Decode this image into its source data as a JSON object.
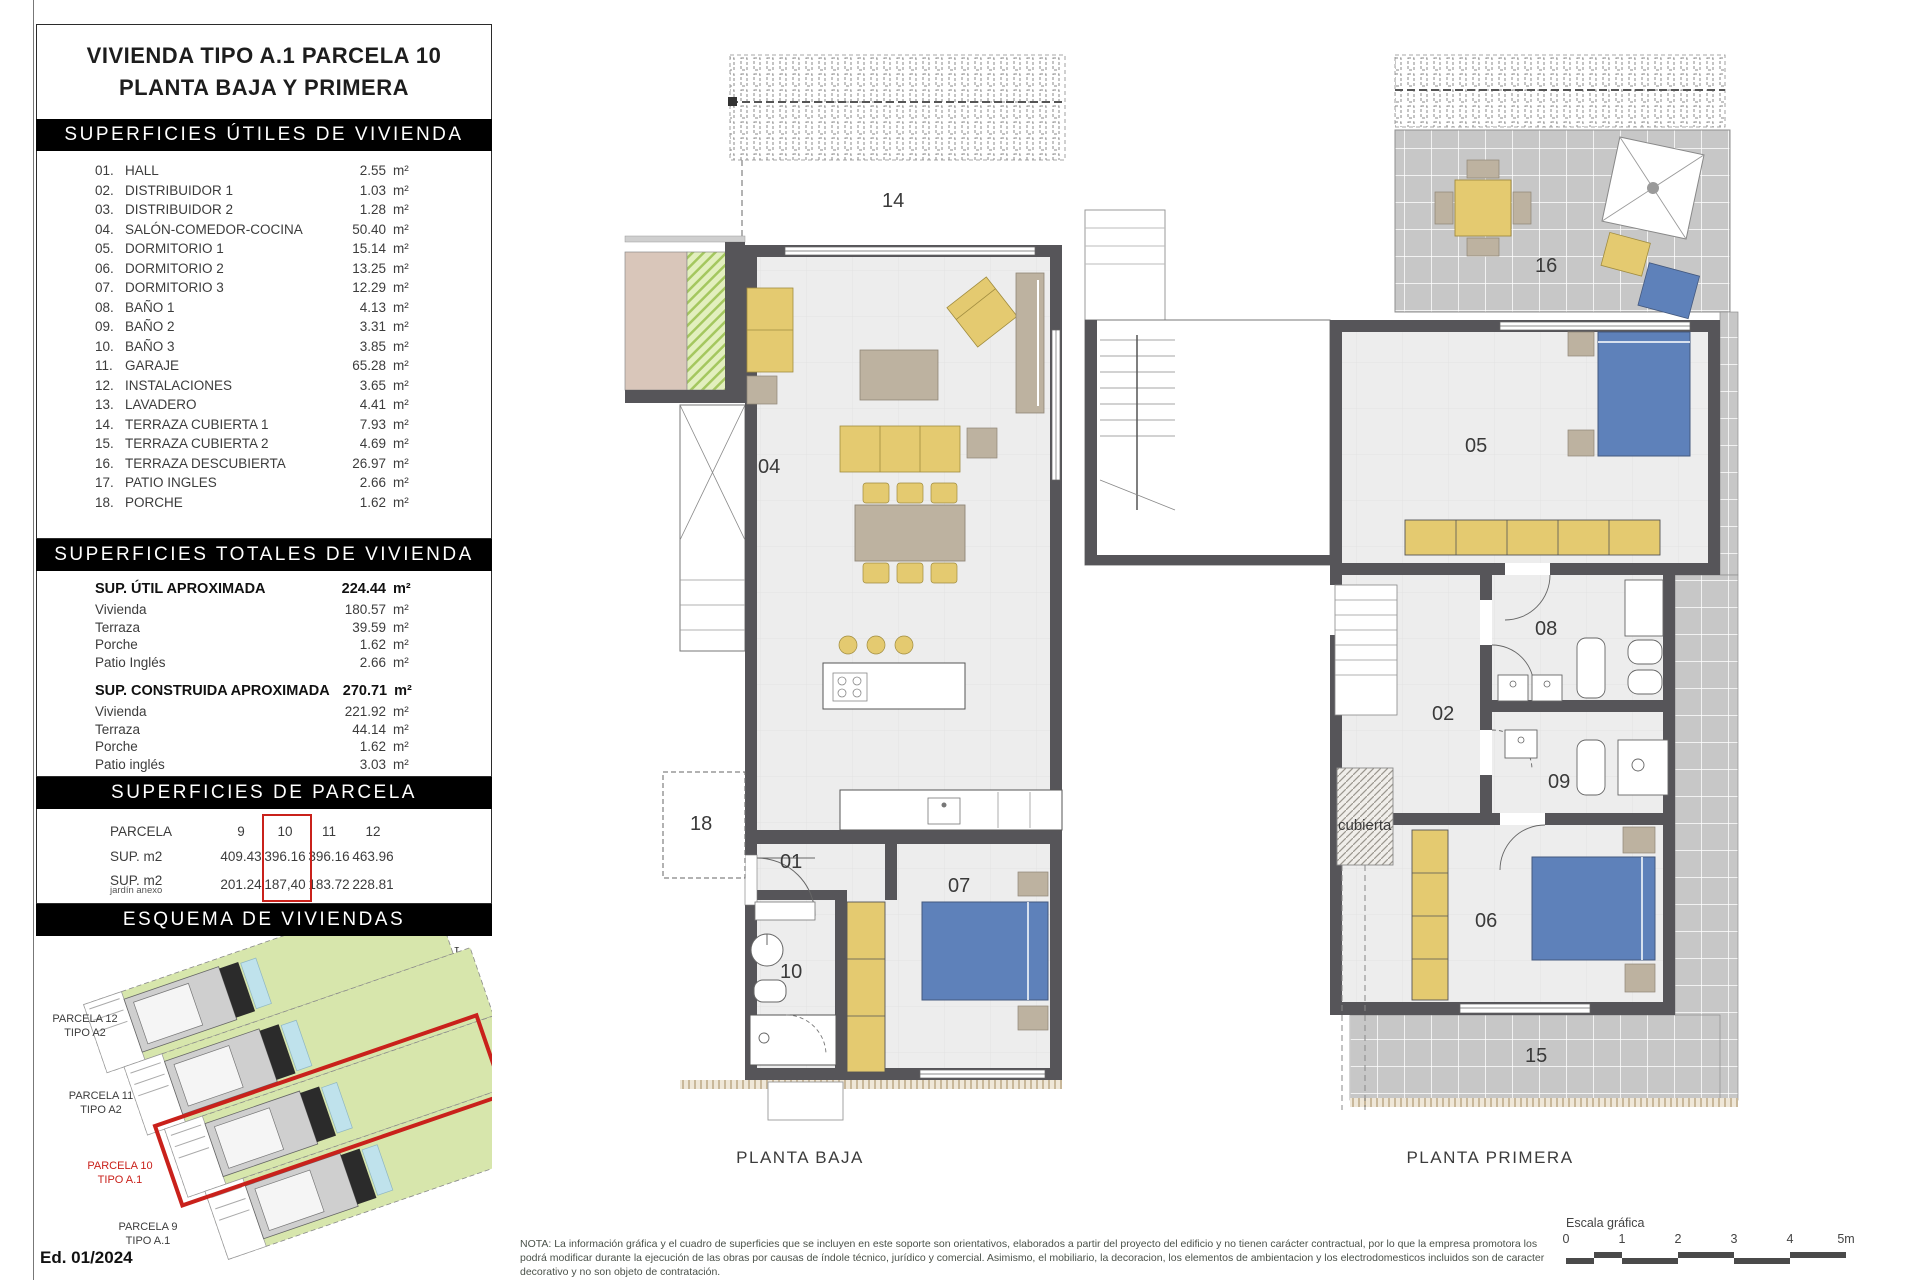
{
  "colors": {
    "accent-red": "#c9211b",
    "wall": "#565559",
    "floor": "#ededed",
    "furniture-yellow": "#e4ca70",
    "bed-blue": "#5e81ba",
    "tile-gray": "#c7c7c7",
    "site-green": "#d7e6ac",
    "pool-cyan": "#bfe2ec",
    "beige": "#bdb2a0"
  },
  "page": {
    "edition": "Ed. 01/2024",
    "north": "N",
    "note": "NOTA: La información gráfica y el cuadro de superficies que se incluyen en este soporte son orientativos, elaborados a partir del proyecto del edificio y no tienen carácter contractual, por lo que la empresa promotora los podrá modificar durante la ejecución de las obras por causas de índole técnico, jurídico y comercial. Asimismo, el mobiliario, la decoracion, los elementos de ambientacion y los electrodomesticos incluidos son de caracter decorativo y no son objeto de contratación."
  },
  "panel": {
    "title_line1": "VIVIENDA TIPO A.1 PARCELA 10",
    "title_line2": "PLANTA BAJA Y PRIMERA",
    "unit": "m²",
    "utiles": {
      "header": "SUPERFICIES ÚTILES DE VIVIENDA",
      "rows": [
        {
          "num": "01.",
          "name": "HALL",
          "value": "2.55"
        },
        {
          "num": "02.",
          "name": "DISTRIBUIDOR 1",
          "value": "1.03"
        },
        {
          "num": "03.",
          "name": "DISTRIBUIDOR 2",
          "value": "1.28"
        },
        {
          "num": "04.",
          "name": "SALÓN-COMEDOR-COCINA",
          "value": "50.40"
        },
        {
          "num": "05.",
          "name": "DORMITORIO 1",
          "value": "15.14"
        },
        {
          "num": "06.",
          "name": "DORMITORIO 2",
          "value": "13.25"
        },
        {
          "num": "07.",
          "name": "DORMITORIO 3",
          "value": "12.29"
        },
        {
          "num": "08.",
          "name": "BAÑO 1",
          "value": "4.13"
        },
        {
          "num": "09.",
          "name": "BAÑO 2",
          "value": "3.31"
        },
        {
          "num": "10.",
          "name": "BAÑO 3",
          "value": "3.85"
        },
        {
          "num": "11.",
          "name": "GARAJE",
          "value": "65.28"
        },
        {
          "num": "12.",
          "name": "INSTALACIONES",
          "value": "3.65"
        },
        {
          "num": "13.",
          "name": "LAVADERO",
          "value": "4.41"
        },
        {
          "num": "14.",
          "name": "TERRAZA CUBIERTA 1",
          "value": "7.93"
        },
        {
          "num": "15.",
          "name": "TERRAZA CUBIERTA 2",
          "value": "4.69"
        },
        {
          "num": "16.",
          "name": "TERRAZA DESCUBIERTA",
          "value": "26.97"
        },
        {
          "num": "17.",
          "name": "PATIO INGLES",
          "value": "2.66"
        },
        {
          "num": "18.",
          "name": "PORCHE",
          "value": "1.62"
        }
      ]
    },
    "totales": {
      "header": "SUPERFICIES TOTALES DE VIVIENDA",
      "blocks": [
        {
          "label": "SUP. ÚTIL APROXIMADA",
          "value": "224.44",
          "rows": [
            {
              "name": "Vivienda",
              "value": "180.57"
            },
            {
              "name": "Terraza",
              "value": "39.59"
            },
            {
              "name": "Porche",
              "value": "1.62"
            },
            {
              "name": "Patio Inglés",
              "value": "2.66"
            }
          ]
        },
        {
          "label": "SUP. CONSTRUIDA APROXIMADA",
          "value": "270.71",
          "rows": [
            {
              "name": "Vivienda",
              "value": "221.92"
            },
            {
              "name": "Terraza",
              "value": "44.14"
            },
            {
              "name": "Porche",
              "value": "1.62"
            },
            {
              "name": "Patio inglés",
              "value": "3.03"
            }
          ]
        }
      ]
    },
    "parcela": {
      "header": "SUPERFICIES DE PARCELA",
      "row_label": "PARCELA",
      "cols": [
        "9",
        "10",
        "11",
        "12"
      ],
      "highlight_col": "10",
      "sup_label": "SUP. m2",
      "sup_values": [
        "409.43",
        "396.16",
        "396.16",
        "463.96"
      ],
      "jardin_label": "SUP. m2",
      "jardin_sublabel": "jardín anexo",
      "jardin_values": [
        "201.24",
        "187,40",
        "183.72",
        "228.81"
      ]
    },
    "esquema": {
      "header": "ESQUEMA DE VIVIENDAS",
      "parcels": [
        {
          "line1": "PARCELA 12",
          "line2": "TIPO A2",
          "highlight": false
        },
        {
          "line1": "PARCELA 11",
          "line2": "TIPO A2",
          "highlight": false
        },
        {
          "line1": "PARCELA 10",
          "line2": "TIPO A.1",
          "highlight": true
        },
        {
          "line1": "PARCELA 9",
          "line2": "TIPO A.1",
          "highlight": false
        }
      ]
    }
  },
  "plans": {
    "baja": {
      "caption": "PLANTA BAJA",
      "labels": [
        "14",
        "04",
        "18",
        "01",
        "10",
        "07"
      ]
    },
    "primera": {
      "caption": "PLANTA PRIMERA",
      "labels": [
        "16",
        "05",
        "08",
        "02",
        "09",
        "06",
        "15",
        "cubierta"
      ]
    }
  },
  "scale": {
    "label": "Escala gráfica",
    "ticks": [
      "0",
      "1",
      "2",
      "3",
      "4",
      "5m"
    ]
  }
}
